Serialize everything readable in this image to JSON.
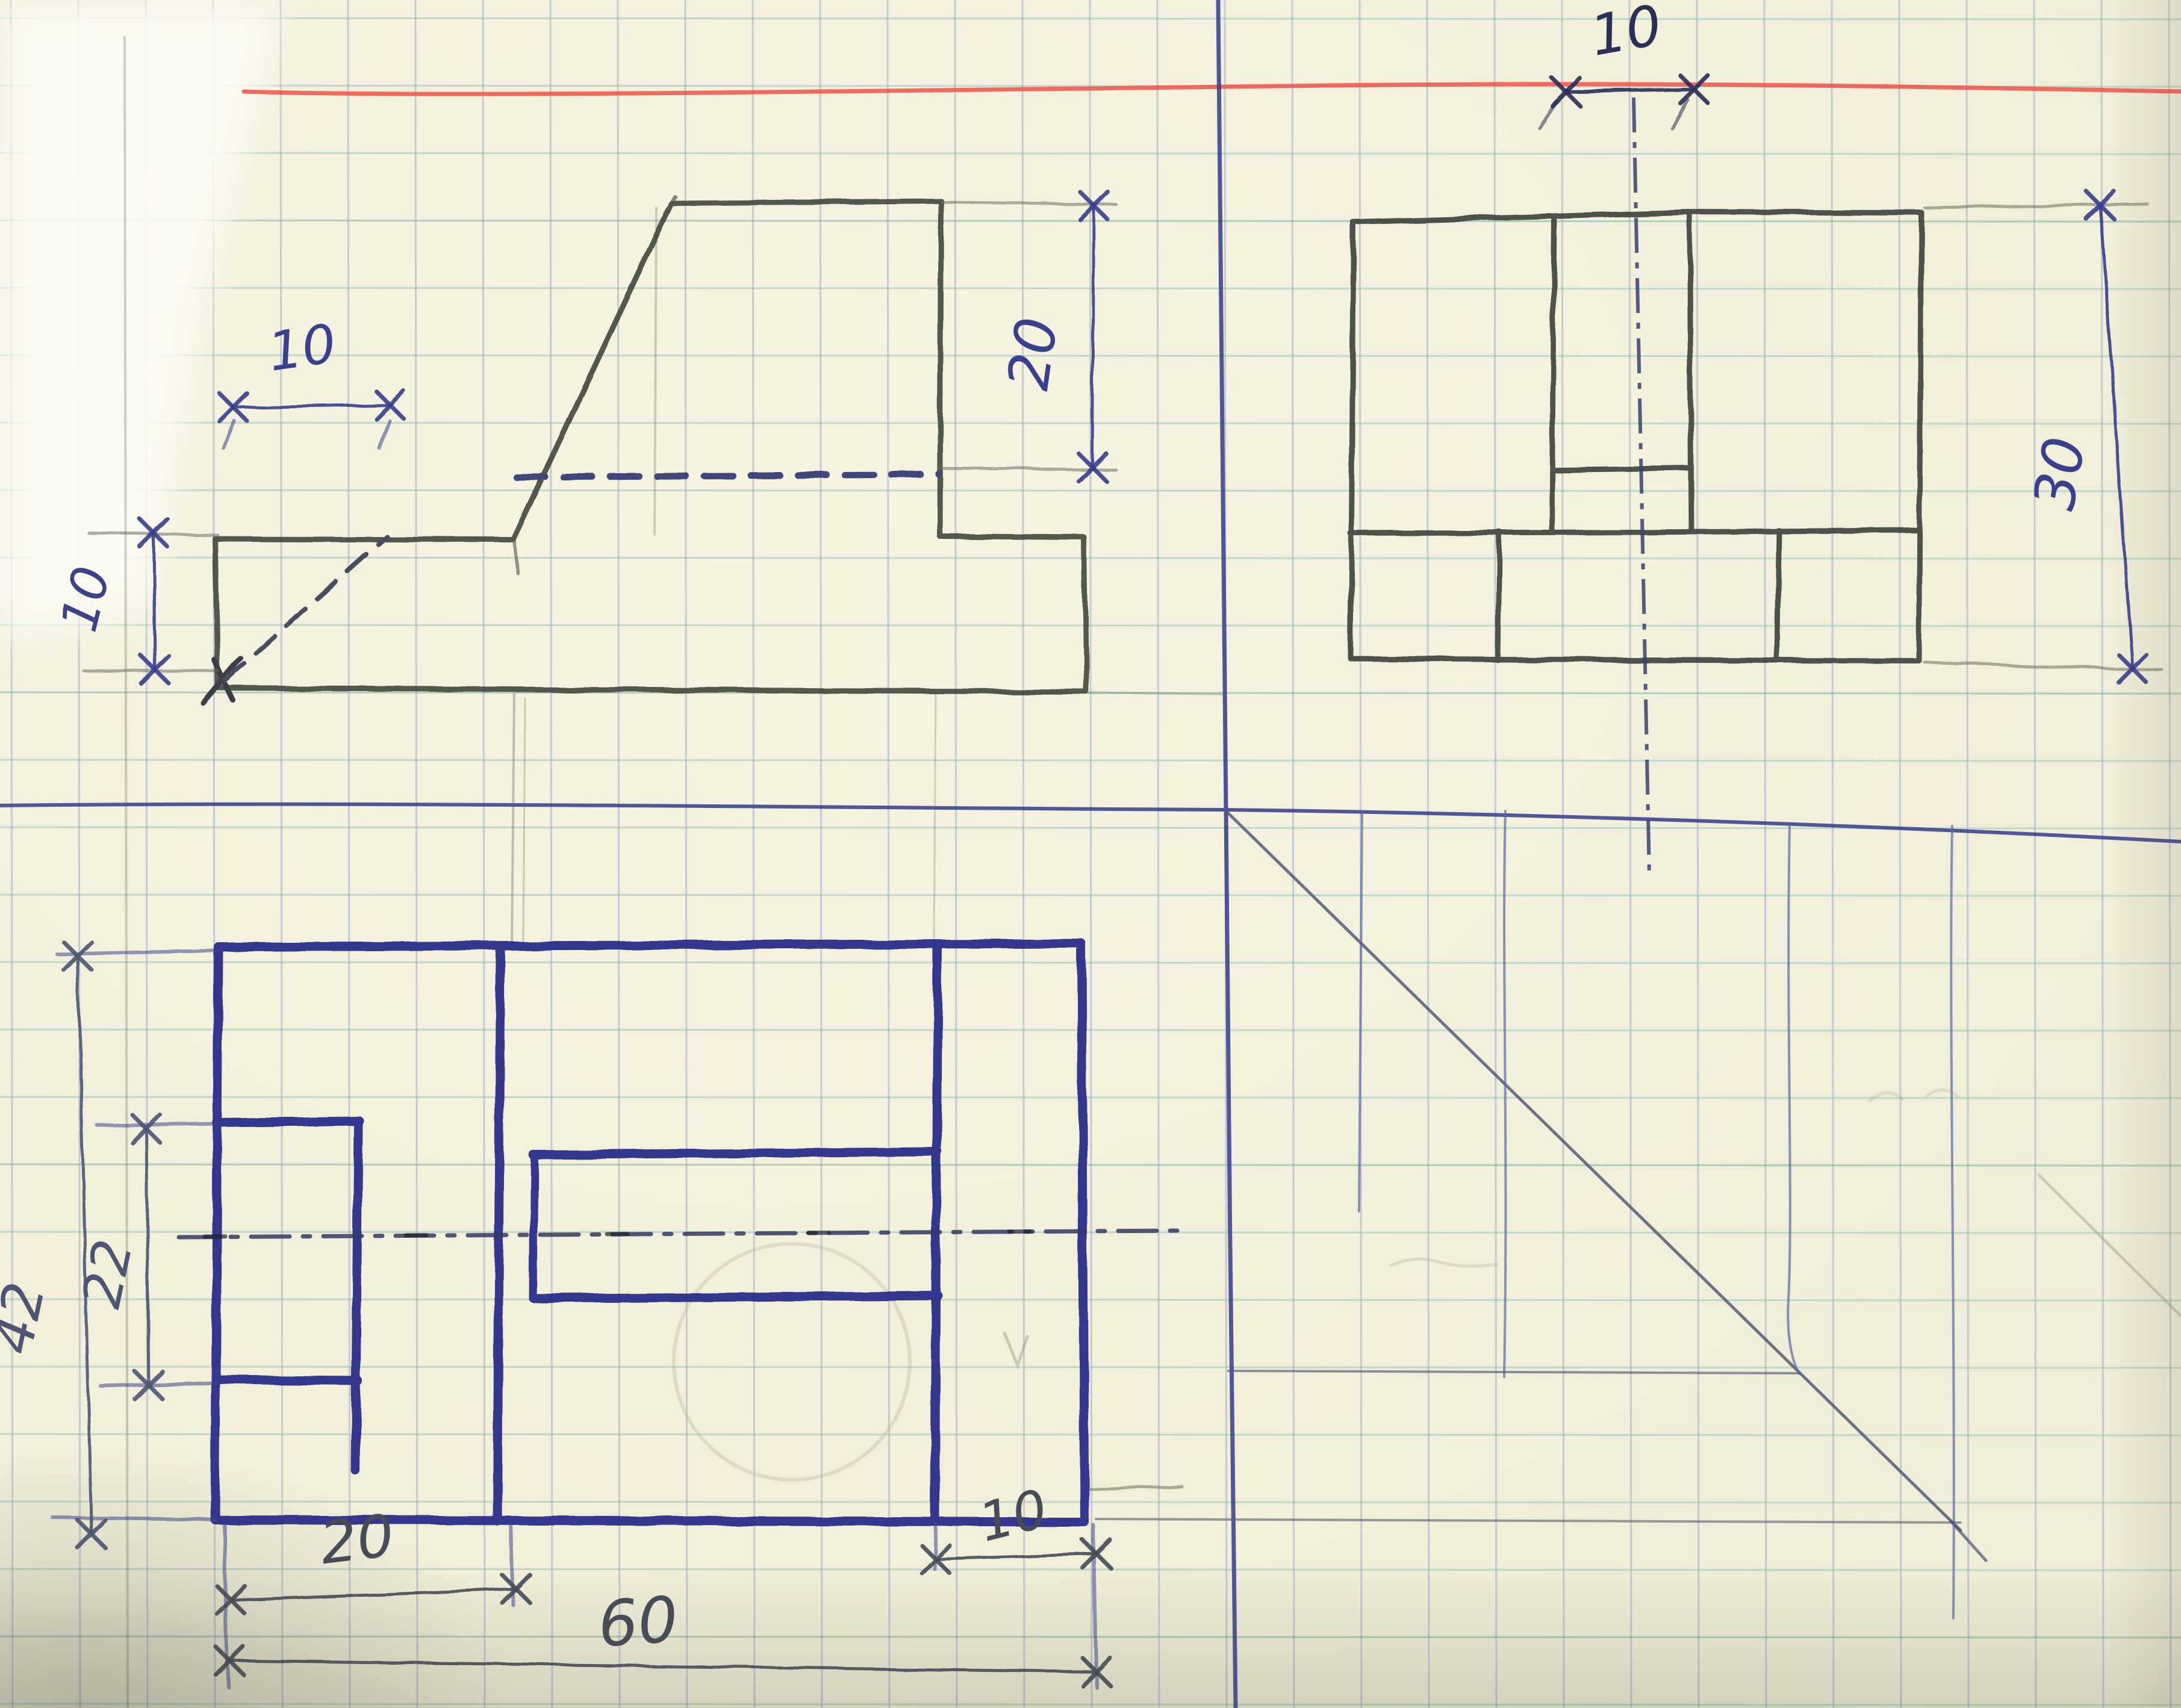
{
  "document": {
    "kind": "hand-drawn orthographic projection sketch",
    "medium": "pencil and blue ballpoint ink on squared (5 mm) notebook paper",
    "features": [
      "red margin line",
      "page divider axis line",
      "horizontal ground line",
      "45-degree miter projection line",
      "dash-dot center lines",
      "dashed hidden lines",
      "erased construction circle"
    ]
  },
  "colors": {
    "paper": "#f0edd8",
    "grid_vertical": "#8494c4",
    "grid_horizontal": "#7fb8b2",
    "red_margin": "#f0524a",
    "blue_ink": "#2c2f8a",
    "dark_ink": "#2b2f55",
    "pencil": "#43463c",
    "axis_ink": "#39418f"
  },
  "views": [
    {
      "name": "front view (upper left, pencil)",
      "dimension_values": [
        "10",
        "10",
        "20"
      ]
    },
    {
      "name": "side view (upper right, pencil)",
      "dimension_values": [
        "10",
        "30"
      ]
    },
    {
      "name": "top view (lower left, blue ink)",
      "dimension_values": [
        "42",
        "22",
        "20",
        "60",
        "10"
      ]
    }
  ],
  "labels": [
    {
      "id": "front-top-10",
      "value": "10",
      "color": "#383f8c"
    },
    {
      "id": "front-left-10",
      "value": "10",
      "color": "#3d4284"
    },
    {
      "id": "front-right-20",
      "value": "20",
      "color": "#383f8c"
    },
    {
      "id": "side-top-10",
      "value": "10",
      "color": "#2b2f55"
    },
    {
      "id": "side-right-30",
      "value": "30",
      "color": "#383f8c"
    },
    {
      "id": "top-left-42",
      "value": "42",
      "color": "#4e5574"
    },
    {
      "id": "top-left-22",
      "value": "22",
      "color": "#4e5574"
    },
    {
      "id": "top-bottom-20",
      "value": "20",
      "color": "#474c58"
    },
    {
      "id": "top-bottom-60",
      "value": "60",
      "color": "#474c58"
    },
    {
      "id": "top-bottom-10",
      "value": "10",
      "color": "#474c58"
    }
  ]
}
